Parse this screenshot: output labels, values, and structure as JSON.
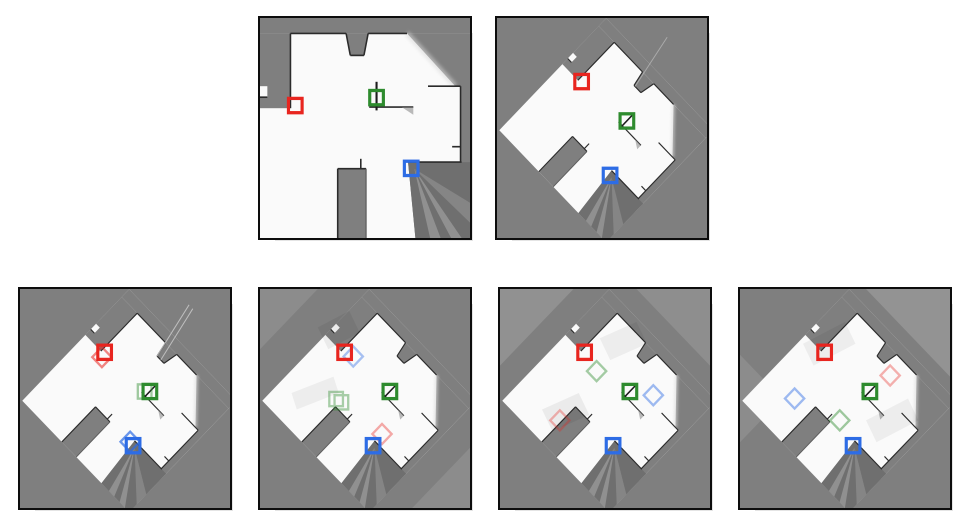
{
  "page": {
    "type": "figure-grid",
    "background": "#ffffff",
    "rows": [
      {
        "name": "reference-maps",
        "panel_count": 2
      },
      {
        "name": "merged-maps",
        "panel_count": 4
      }
    ]
  },
  "colors": {
    "unknown_space": "#7f7f7f",
    "free_space": "#fafafa",
    "wall": "#2b2b2b",
    "panel_border": "#0d0d0d",
    "marker_red": "#e8251f",
    "marker_green": "#2e8b2e",
    "marker_blue": "#2d6ce5"
  },
  "coordinate_space": "panel units 0-200 (x right, y down)",
  "panels": [
    {
      "id": "map-reference-axis-aligned",
      "row": 1,
      "col": 1,
      "map_rotation_deg": 0,
      "markers": [
        {
          "agent": "red",
          "shape": "square",
          "color": "#e8251f",
          "x": 33.6,
          "y": 79.6
        },
        {
          "agent": "green",
          "shape": "square",
          "color": "#2e8b2e",
          "x": 111.0,
          "y": 72.4
        },
        {
          "agent": "blue",
          "shape": "square",
          "color": "#2d6ce5",
          "x": 144.0,
          "y": 136.7
        }
      ],
      "ghost_markers": []
    },
    {
      "id": "map-reference-rotated",
      "row": 1,
      "col": 2,
      "map_rotation_deg": 45,
      "markers": [
        {
          "agent": "red",
          "shape": "square",
          "color": "#e8251f",
          "x": 80.6,
          "y": 57.8
        },
        {
          "agent": "green",
          "shape": "square",
          "color": "#2e8b2e",
          "x": 123.7,
          "y": 93.6
        },
        {
          "agent": "blue",
          "shape": "square",
          "color": "#2d6ce5",
          "x": 107.7,
          "y": 143.1
        }
      ],
      "ghost_markers": []
    },
    {
      "id": "merged-map-1",
      "row": 2,
      "col": 1,
      "map_rotation_deg": 45,
      "markers": [
        {
          "agent": "red",
          "shape": "square",
          "color": "#e8251f",
          "x": 80.6,
          "y": 57.8
        },
        {
          "agent": "green",
          "shape": "square",
          "color": "#2e8b2e",
          "x": 123.7,
          "y": 93.6
        },
        {
          "agent": "blue",
          "shape": "square",
          "color": "#2d6ce5",
          "x": 107.7,
          "y": 143.1
        }
      ],
      "ghost_markers": [
        {
          "agent": "red",
          "shape": "diamond",
          "color": "#e8251f",
          "opacity": 0.55,
          "x": 78.0,
          "y": 62.2
        },
        {
          "agent": "green",
          "shape": "square",
          "color": "#2e8b2e",
          "opacity": 0.45,
          "x": 118.7,
          "y": 93.6
        },
        {
          "agent": "blue",
          "shape": "diamond",
          "color": "#2d6ce5",
          "opacity": 0.7,
          "x": 104.9,
          "y": 139.5
        }
      ]
    },
    {
      "id": "merged-map-2",
      "row": 2,
      "col": 2,
      "map_rotation_deg": 45,
      "markers": [
        {
          "agent": "red",
          "shape": "square",
          "color": "#e8251f",
          "x": 80.6,
          "y": 57.8
        },
        {
          "agent": "green",
          "shape": "square",
          "color": "#2e8b2e",
          "x": 123.7,
          "y": 93.6
        },
        {
          "agent": "blue",
          "shape": "square",
          "color": "#2d6ce5",
          "x": 107.7,
          "y": 143.1
        }
      ],
      "ghost_markers": [
        {
          "agent": "blue",
          "shape": "diamond",
          "color": "#2d6ce5",
          "opacity": 0.4,
          "x": 88.8,
          "y": 61.6
        },
        {
          "agent": "green",
          "shape": "double-square",
          "color": "#2e8b2e",
          "opacity": 0.4,
          "x": 75.0,
          "y": 102.0
        },
        {
          "agent": "red",
          "shape": "diamond",
          "color": "#e8251f",
          "opacity": 0.38,
          "x": 116.2,
          "y": 132.4
        }
      ]
    },
    {
      "id": "merged-map-3",
      "row": 2,
      "col": 3,
      "map_rotation_deg": 45,
      "markers": [
        {
          "agent": "red",
          "shape": "square",
          "color": "#e8251f",
          "x": 80.6,
          "y": 57.8
        },
        {
          "agent": "green",
          "shape": "square",
          "color": "#2e8b2e",
          "x": 123.7,
          "y": 93.6
        },
        {
          "agent": "blue",
          "shape": "square",
          "color": "#2d6ce5",
          "x": 107.7,
          "y": 143.1
        }
      ],
      "ghost_markers": [
        {
          "agent": "green",
          "shape": "diamond",
          "color": "#2e8b2e",
          "opacity": 0.42,
          "x": 92.0,
          "y": 75.0
        },
        {
          "agent": "blue",
          "shape": "diamond",
          "color": "#2d6ce5",
          "opacity": 0.45,
          "x": 146.0,
          "y": 97.0
        },
        {
          "agent": "red",
          "shape": "diamond",
          "color": "#e8251f",
          "opacity": 0.32,
          "x": 57.0,
          "y": 120.0
        }
      ]
    },
    {
      "id": "merged-map-4",
      "row": 2,
      "col": 4,
      "map_rotation_deg": 45,
      "markers": [
        {
          "agent": "red",
          "shape": "square",
          "color": "#e8251f",
          "x": 80.6,
          "y": 57.8
        },
        {
          "agent": "green",
          "shape": "square",
          "color": "#2e8b2e",
          "x": 123.7,
          "y": 93.6
        },
        {
          "agent": "blue",
          "shape": "square",
          "color": "#2d6ce5",
          "x": 107.7,
          "y": 143.1
        }
      ],
      "ghost_markers": [
        {
          "agent": "red",
          "shape": "diamond",
          "color": "#e8251f",
          "opacity": 0.35,
          "x": 143.0,
          "y": 79.0
        },
        {
          "agent": "blue",
          "shape": "diamond",
          "color": "#2d6ce5",
          "opacity": 0.45,
          "x": 52.0,
          "y": 100.0
        },
        {
          "agent": "green",
          "shape": "diamond",
          "color": "#2e8b2e",
          "opacity": 0.45,
          "x": 95.0,
          "y": 120.0
        }
      ]
    }
  ]
}
